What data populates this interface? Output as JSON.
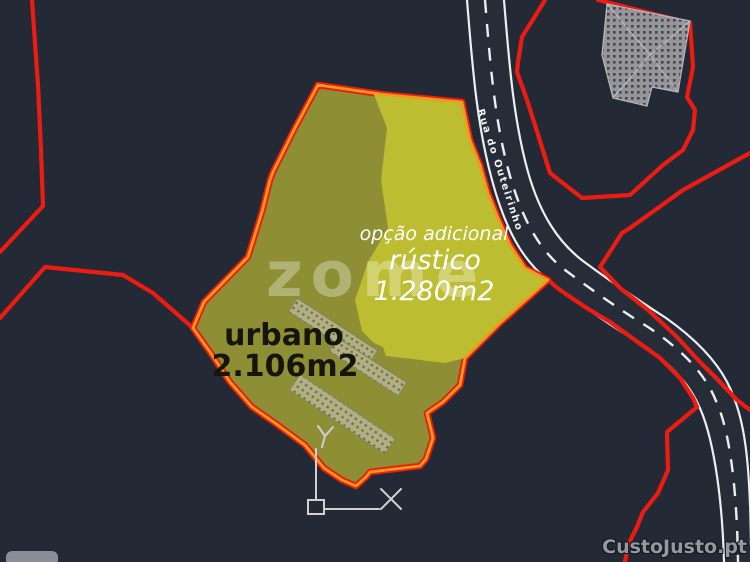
{
  "scene": {
    "type": "cadastral-cad-plan",
    "background_color": "#242936"
  },
  "parcel": {
    "urban": {
      "name": "urbano",
      "area": "2.106m2",
      "fill_color": "#8e8e34"
    },
    "rustic": {
      "name": "rústico",
      "area": "1.280m2",
      "note": "opção adicional",
      "fill_color": "#bdbd32"
    },
    "outline_colors": {
      "outer": "#ec1c12",
      "inner": "#f09a1c"
    }
  },
  "road": {
    "name": "Rua do Outeirinho"
  },
  "watermarks": {
    "center_brand": "zome",
    "bottom_right_site": "CustoJusto.pt"
  },
  "ucs_icon": {
    "x_label": "X",
    "y_label": "Y"
  },
  "colors": {
    "background": "#242936",
    "boundary_red": "#ec1c12",
    "parcel_orange": "#f09a1c",
    "urban_olive": "#8e8e34",
    "rustic_yellow": "#bdbd32",
    "road_fill": "#272c39",
    "road_markings": "#eceef0"
  }
}
